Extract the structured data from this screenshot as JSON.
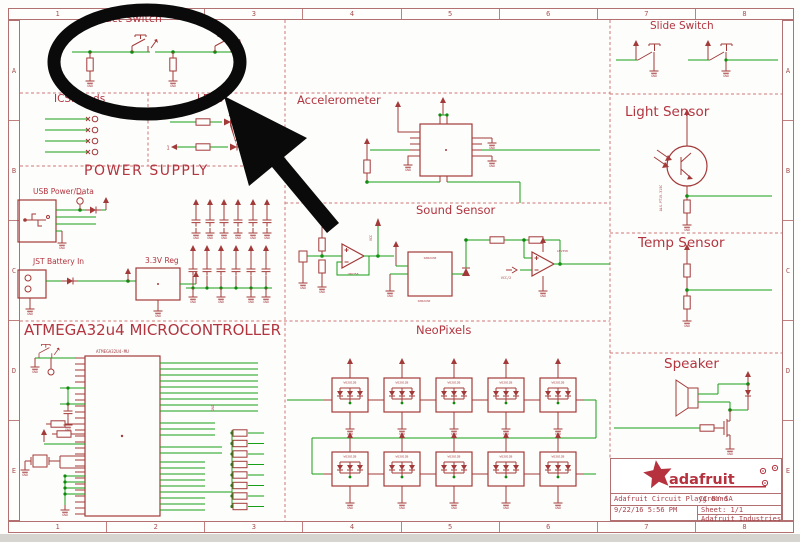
{
  "colors": {
    "schematic_red": "#a33a3a",
    "wire_green": "#17a017",
    "annotation_black": "#0a0a0a",
    "frame_red": "#b37070"
  },
  "frame": {
    "columns": [
      "1",
      "2",
      "3",
      "4",
      "5",
      "6",
      "7",
      "8"
    ],
    "rows": [
      "A",
      "B",
      "C",
      "D",
      "E"
    ]
  },
  "labels": {
    "gnd": "GND",
    "vcc": "VCC",
    "vbus": "VBUS",
    "neopixel": "WS2812B"
  },
  "sections": {
    "tact_switch": {
      "title": "Tact Switch"
    },
    "icsp_pads": {
      "title": "ICSP Pads"
    },
    "leds": {
      "title": "LEDs",
      "pin_label": "1"
    },
    "power_supply": {
      "title": "POWER SUPPLY",
      "usb_label": "USB Power/Data",
      "jst_label": "JST Battery In",
      "reg_label": "3.3V Reg"
    },
    "accelerometer": {
      "title": "Accelerometer"
    },
    "sound_sensor": {
      "title": "Sound Sensor",
      "opamp": "LMV358",
      "mic": "SPW2430",
      "ref": "VCC/2"
    },
    "atmega": {
      "title": "ATMEGA32u4 MICROCONTROLLER",
      "chip": "ATMEGA32U4-MU"
    },
    "neopixels": {
      "title": "NeoPixels"
    },
    "slide_switch": {
      "title": "Slide Switch"
    },
    "light_sensor": {
      "title": "Light Sensor",
      "part": "ALS-PT19-315C"
    },
    "temp_sensor": {
      "title": "Temp Sensor"
    },
    "speaker": {
      "title": "Speaker"
    }
  },
  "title_block": {
    "logo_text": "adafruit",
    "doc_title": "Adafruit Circuit Playground",
    "license": "CC BY-SA",
    "date": "9/22/16 5:56 PM",
    "sheet": "Sheet: 1/1",
    "company": "Adafruit Industries"
  }
}
